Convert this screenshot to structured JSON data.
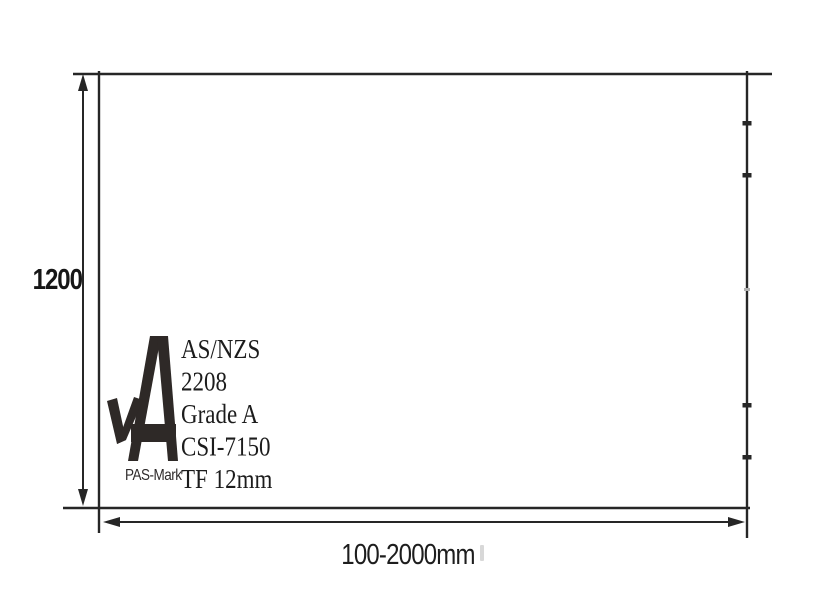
{
  "colors": {
    "line": "#262626",
    "logo": "#2e2927",
    "tick_faint": "#b0b0b0"
  },
  "dimensions": {
    "height_label": "1200",
    "width_label": "100-2000mm"
  },
  "certification_mark": {
    "name": "PAS-Mark",
    "standard_lines": [
      "AS/NZS",
      "2208",
      "Grade A",
      "CSI-7150",
      "TF 12mm"
    ]
  }
}
